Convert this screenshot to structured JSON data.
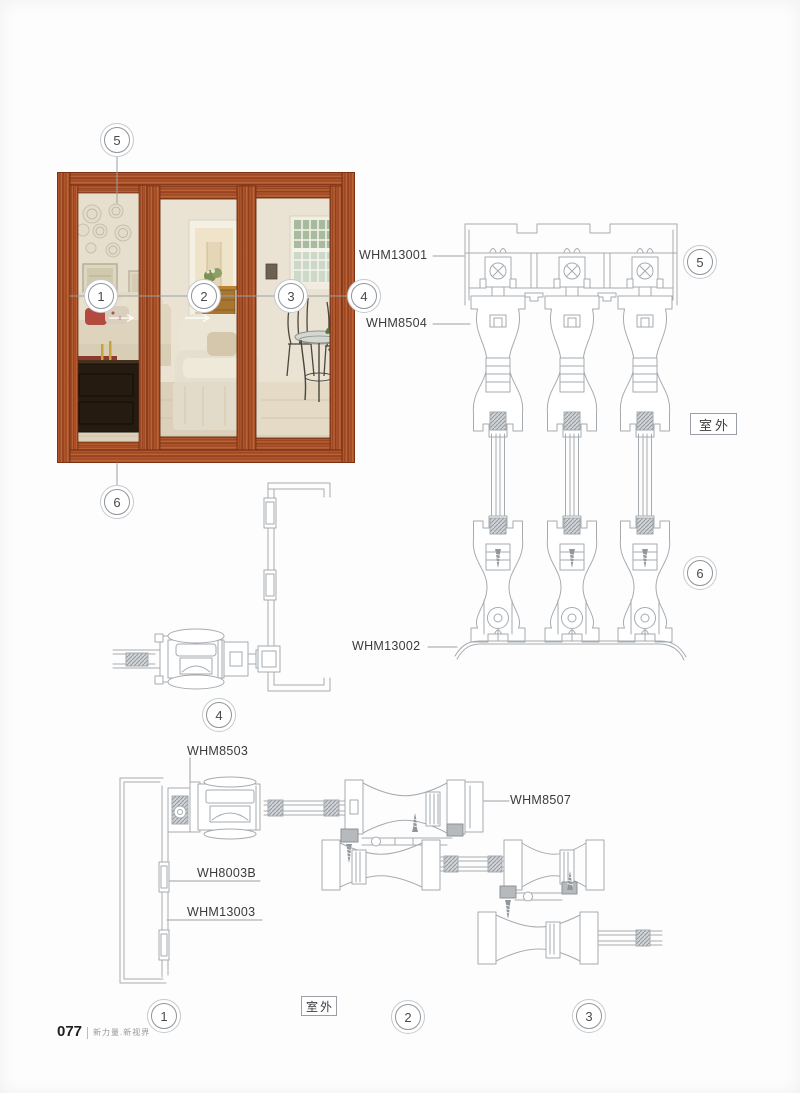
{
  "page": {
    "number": "077",
    "slogan": "新力量.新视界"
  },
  "environment_label": "室外",
  "callouts": {
    "n1": "1",
    "n2": "2",
    "n3": "3",
    "n4": "4",
    "n5": "5",
    "n6": "6"
  },
  "part_labels": {
    "whm13001": "WHM13001",
    "whm8504": "WHM8504",
    "whm13002": "WHM13002",
    "whm8503": "WHM8503",
    "whm8507": "WHM8507",
    "wh8003b": "WH8003B",
    "whm13003": "WHM13003"
  },
  "colors": {
    "drawing_line": "#a6abb0",
    "wood_frame": "#9e4423",
    "label_text": "#3b3b3b",
    "hatch_fill": "#b6babd"
  }
}
